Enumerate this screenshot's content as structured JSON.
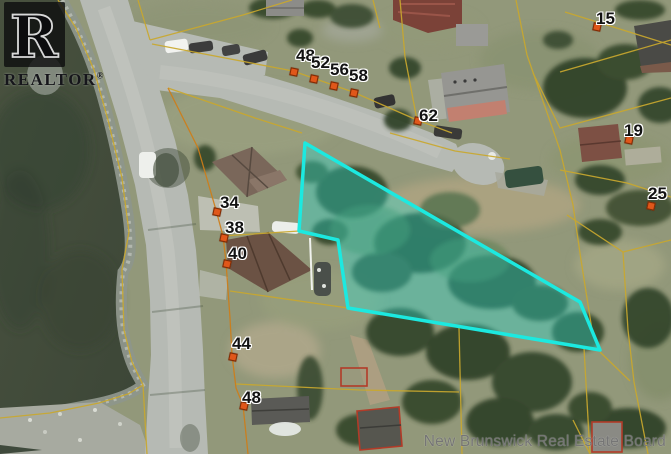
{
  "watermark": "New Brunswick Real Estate Board",
  "logo": {
    "letter": "R",
    "brand": "REALTOR",
    "reg": "®"
  },
  "highlight": {
    "points": "305,143 580,302 600,350 348,308 338,240 299,231",
    "stroke": "#1ce9e0",
    "fill": "rgba(40,224,214,0.36)"
  },
  "address_labels": [
    {
      "text": "48",
      "x": 296,
      "y": 47
    },
    {
      "text": "52",
      "x": 311,
      "y": 54
    },
    {
      "text": "56",
      "x": 330,
      "y": 61
    },
    {
      "text": "58",
      "x": 349,
      "y": 67
    },
    {
      "text": "62",
      "x": 419,
      "y": 107
    },
    {
      "text": "34",
      "x": 220,
      "y": 194
    },
    {
      "text": "38",
      "x": 225,
      "y": 219
    },
    {
      "text": "40",
      "x": 228,
      "y": 245
    },
    {
      "text": "44",
      "x": 232,
      "y": 335
    },
    {
      "text": "48",
      "x": 242,
      "y": 389
    },
    {
      "text": "15",
      "x": 596,
      "y": 10
    },
    {
      "text": "19",
      "x": 624,
      "y": 122
    },
    {
      "text": "25",
      "x": 648,
      "y": 185
    }
  ],
  "markers": [
    {
      "x": 293,
      "y": 71
    },
    {
      "x": 313,
      "y": 78
    },
    {
      "x": 333,
      "y": 85
    },
    {
      "x": 353,
      "y": 92
    },
    {
      "x": 417,
      "y": 120
    },
    {
      "x": 216,
      "y": 211
    },
    {
      "x": 223,
      "y": 237
    },
    {
      "x": 226,
      "y": 263
    },
    {
      "x": 232,
      "y": 356
    },
    {
      "x": 243,
      "y": 405
    },
    {
      "x": 596,
      "y": 26
    },
    {
      "x": 628,
      "y": 139
    },
    {
      "x": 650,
      "y": 205
    }
  ],
  "colors": {
    "marker": "#e0571a",
    "cadastral_yellow": "#c9a82e",
    "cadastral_orange": "#cf7d18",
    "water": "#46503f",
    "road": "#b6bab4",
    "building_outline_red": "#b23b28"
  }
}
